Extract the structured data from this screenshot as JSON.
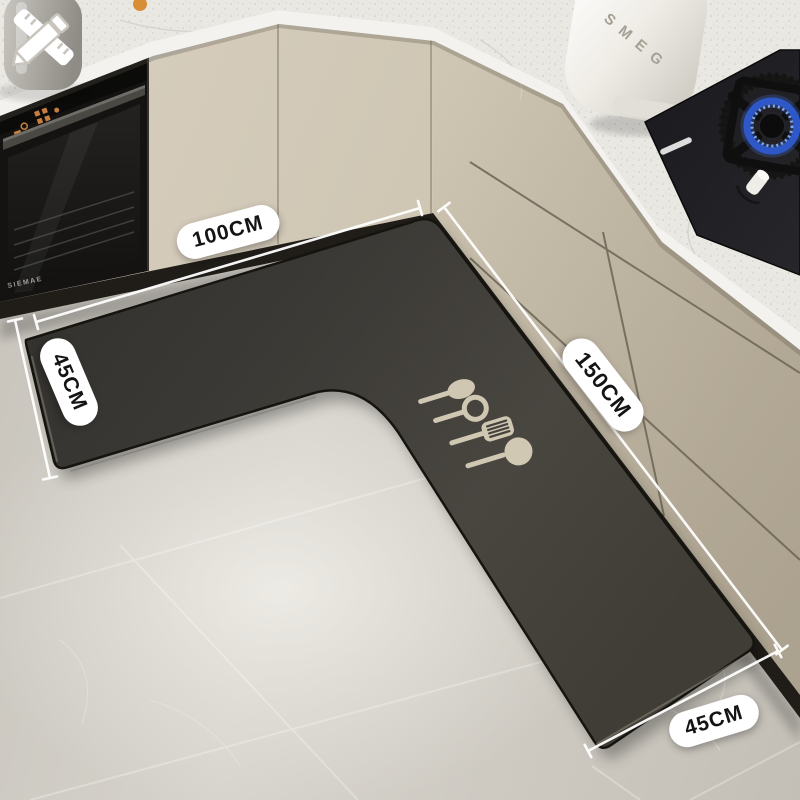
{
  "product_scene": {
    "mat": {
      "dimension_labels": {
        "top": "100CM",
        "left": "45CM",
        "right": "150CM",
        "bottom": "45CM"
      },
      "print_icons": [
        "spoon",
        "skimmer-spoon",
        "slotted-spatula",
        "ladle"
      ],
      "shape": "L-shaped corner kitchen mat"
    },
    "appliances": {
      "kettle_brand": "SMEG",
      "oven_brand": "SIEMAE"
    },
    "icons": {
      "customize": "pencil-ruler-icon"
    },
    "colors": {
      "mat": "#3f3c37",
      "floor": "#cdc9c1",
      "cabinet": "#cfc6b4",
      "countertop": "#eae8e2",
      "label_background": "#ffffff",
      "label_text": "#141414",
      "utensil_print": "#d8cfba",
      "flame_blue": "#3563d0",
      "oven_indicator_orange": "#c87f3e"
    }
  }
}
